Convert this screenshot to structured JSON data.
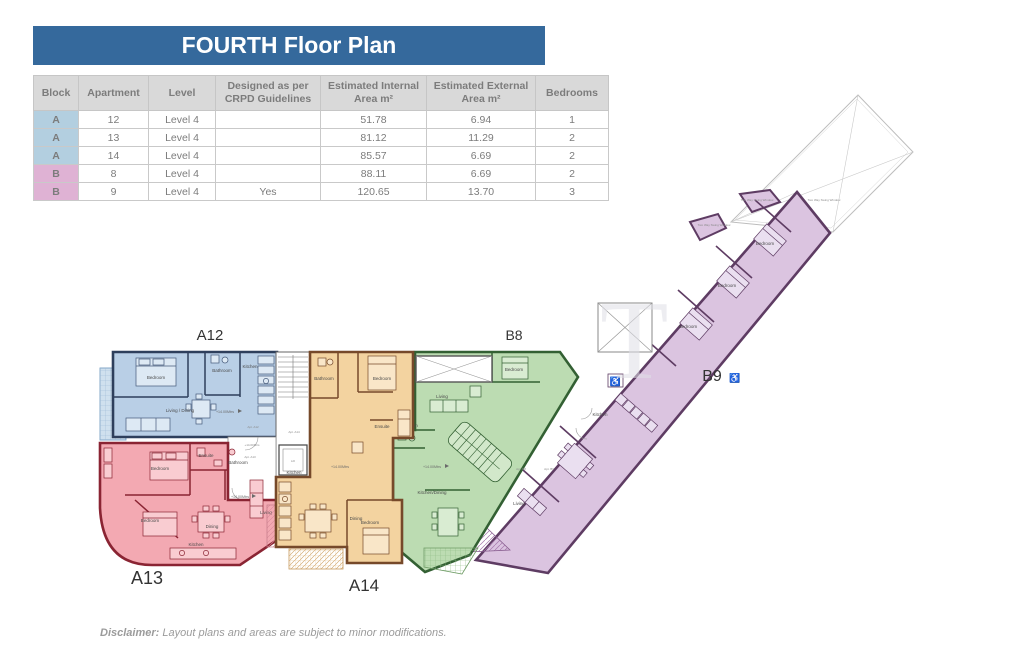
{
  "title": "FOURTH Floor Plan",
  "table": {
    "headers": [
      "Block",
      "Apartment",
      "Level",
      "Designed as per CRPD Guidelines",
      "Estimated Internal Area m²",
      "Estimated External Area m²",
      "Bedrooms"
    ],
    "rows": [
      {
        "block": "A",
        "apartment": "12",
        "level": "Level 4",
        "crpd": "",
        "internal": "51.78",
        "external": "6.94",
        "bedrooms": "1"
      },
      {
        "block": "A",
        "apartment": "13",
        "level": "Level 4",
        "crpd": "",
        "internal": "81.12",
        "external": "11.29",
        "bedrooms": "2"
      },
      {
        "block": "A",
        "apartment": "14",
        "level": "Level 4",
        "crpd": "",
        "internal": "85.57",
        "external": "6.69",
        "bedrooms": "2"
      },
      {
        "block": "B",
        "apartment": "8",
        "level": "Level 4",
        "crpd": "",
        "internal": "88.11",
        "external": "6.69",
        "bedrooms": "2"
      },
      {
        "block": "B",
        "apartment": "9",
        "level": "Level 4",
        "crpd": "Yes",
        "internal": "120.65",
        "external": "13.70",
        "bedrooms": "3"
      }
    ]
  },
  "floorplan": {
    "apartments": {
      "a12": "A12",
      "a13": "A13",
      "a14": "A14",
      "b8": "B8",
      "b9": "B9"
    },
    "rooms": {
      "a12_bedroom": "Bedroom",
      "a12_bathroom": "Bathroom",
      "a12_kitchen": "Kitchen",
      "a12_living": "Living / Dining",
      "a13_bedroom1": "Bedroom",
      "a13_bedroom2": "Bedroom",
      "a13_ensuite": "Ensuite",
      "a13_bathroom": "Bathroom",
      "a13_living": "Living",
      "a13_dining": "Dining",
      "a13_kitchen": "Kitchen",
      "a14_bathroom": "Bathroom",
      "a14_bedroom1": "Bedroom",
      "a14_ensuite": "Ensuite",
      "a14_kitchen": "Kitchen",
      "a14_dining": "Dining",
      "a14_bedroom2": "Bedroom",
      "b8_living": "Living",
      "b8_bedroom": "Bedroom",
      "b8_bathroom": "Bathroom",
      "b8_kitchen_dining": "Kitchen/Dining",
      "b9_bedroom1": "Bedroom",
      "b9_bedroom2": "Bedroom",
      "b9_bedroom3": "Bedroom",
      "b9_kitchen": "Kitchen",
      "b9_living": "Living",
      "lift": "Lift"
    },
    "micro_labels": {
      "apt_a12": "Apt. A12",
      "apt_a13": "Apt. A13",
      "apt_a14": "Apt. A14",
      "apt_b8": "Apt. B8",
      "apt_b9": "Apt. B9",
      "window_note": "Two Way Swing Window"
    },
    "level_marker": "+14.00Mtrs",
    "icons": {
      "accessibility": "♿"
    },
    "watermark": "T"
  },
  "disclaimer": {
    "label": "Disclaimer:",
    "text": " Layout plans and areas are subject to minor modifications."
  },
  "colors": {
    "header_blue": "#35699c",
    "table_header_bg": "#d9d9d9",
    "block_a": "#b3cfe0",
    "block_b": "#dfb2d4",
    "apt_blue": "#b9cfe6",
    "apt_red": "#f3a9b2",
    "apt_orange": "#f3d3a0",
    "apt_green": "#bcdcb2",
    "apt_purple": "#dbc4e0"
  }
}
